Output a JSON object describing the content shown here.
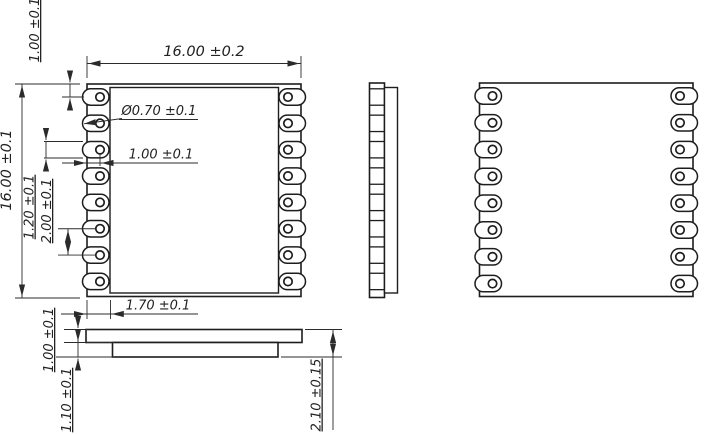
{
  "drawing": {
    "type": "mechanical-dimension-drawing",
    "background": "#ffffff",
    "line_color": "#1d1d1d",
    "dim_color": "#2b2b2b",
    "pads_per_side": 8,
    "dimensions": {
      "module_width": "16.00 ±0.2",
      "module_height": "16.00 ±0.1",
      "edge_to_first_pad": "1.00 ±0.1",
      "hole_diameter": "Ø0.70 ±0.1",
      "edge_to_hole_center": "1.00 ±0.1",
      "pad_width": "1.20 ±0.1",
      "pad_pitch": "2.00 ±0.1",
      "pad_inset": "1.70 ±0.1",
      "pcb_thickness": "1.00 ±0.1",
      "shield_thickness": "1.10 ±0.1",
      "total_thickness": "2.10 ±0.15"
    }
  }
}
